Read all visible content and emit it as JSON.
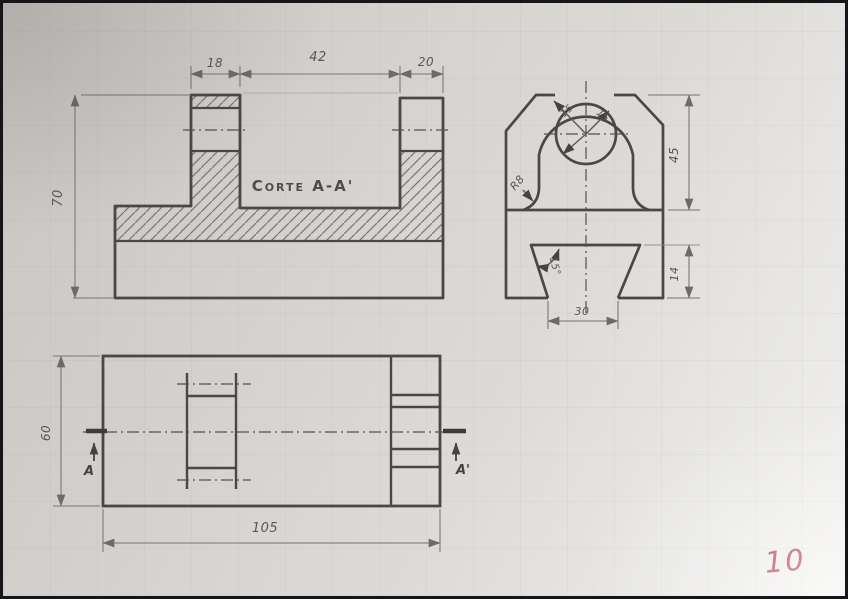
{
  "labels": {
    "front": {
      "dim18": "18",
      "dim42": "42",
      "dim20": "20",
      "dim70": "70",
      "corte": "Corte  A-A'"
    },
    "side": {
      "r15a": "15",
      "r15b": "15",
      "r8": "R8",
      "dim45": "45",
      "dim14": "14",
      "dim30": "30",
      "angle": "15°"
    },
    "plan": {
      "dim60": "60",
      "dim105": "105",
      "a": "A",
      "a_prime": "A'"
    },
    "page_number": "10"
  },
  "colors": {
    "paper": "#d8d5d2",
    "pencil_object": "#4b4744",
    "pencil_thin": "#8b8783",
    "hatch": "#78746f",
    "page_number_red": "#b03347"
  }
}
